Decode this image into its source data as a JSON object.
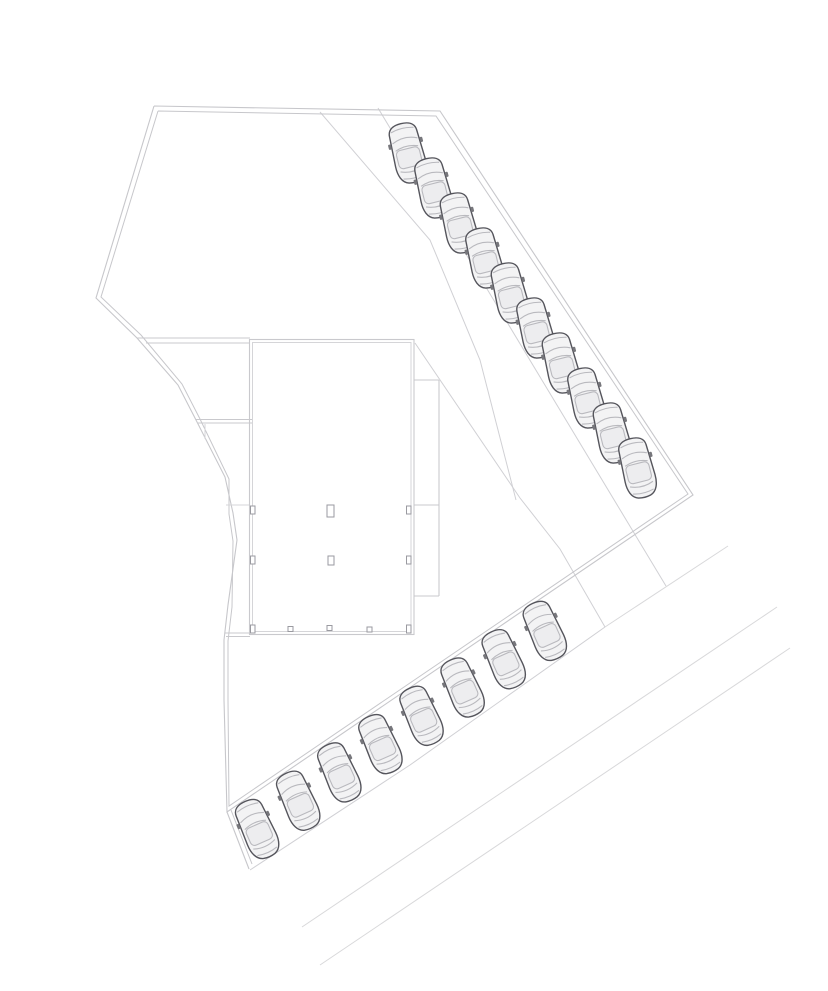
{
  "page": {
    "title": "Architectural site plan with building footprint and angled parking",
    "background": "#ffffff"
  },
  "drawing": {
    "width": 828,
    "height": 991,
    "colors": {
      "boundary": "#c7c7cb",
      "wall": "#c9c9cd",
      "wall_light": "#d5d5d8",
      "aisle_line": "#d0d0d4",
      "road_line": "#d8d8da",
      "car_outline": "#55555c",
      "car_body": "#f3f3f4",
      "car_glass": "#b9b9be",
      "car_roof": "#ededef",
      "car_mirror": "#77777c",
      "column": "#9a9aa0",
      "column_fill": "#ffffff"
    },
    "site_boundary": {
      "outer": [
        [
          154,
          106
        ],
        [
          440,
          111
        ],
        [
          693,
          495
        ],
        [
          227,
          812
        ],
        [
          224,
          700
        ],
        [
          224,
          640
        ],
        [
          228,
          605
        ],
        [
          237,
          540
        ],
        [
          233,
          513
        ],
        [
          225,
          477
        ],
        [
          196,
          420
        ],
        [
          178,
          385
        ],
        [
          137,
          338
        ],
        [
          96,
          298
        ],
        [
          154,
          106
        ]
      ],
      "inner": [
        [
          158,
          111
        ],
        [
          436,
          116
        ],
        [
          688,
          494
        ],
        [
          229,
          806
        ],
        [
          228,
          700
        ],
        [
          228,
          641
        ],
        [
          232,
          607
        ],
        [
          233,
          541
        ],
        [
          229,
          514
        ],
        [
          229,
          479
        ],
        [
          200,
          419
        ],
        [
          182,
          384
        ],
        [
          141,
          335
        ],
        [
          101,
          297
        ],
        [
          158,
          111
        ]
      ],
      "tail_outer": [
        [
          227,
          812
        ],
        [
          249,
          869
        ]
      ],
      "tail_inner": [
        [
          231,
          810
        ],
        [
          252,
          864
        ]
      ]
    },
    "building": {
      "main_hall_outer": [
        249.5,
        339.5,
        164.5,
        295
      ],
      "main_hall_inner": [
        252.5,
        342.5,
        158.5,
        289
      ],
      "annex_lines": [
        [
          [
            414,
            380
          ],
          [
            439,
            380
          ]
        ],
        [
          [
            439,
            380
          ],
          [
            439,
            596
          ]
        ],
        [
          [
            414,
            596
          ],
          [
            439,
            596
          ]
        ],
        [
          [
            414,
            505
          ],
          [
            439,
            505
          ]
        ]
      ],
      "wing_walls": [
        [
          [
            137,
            338
          ],
          [
            250,
            338
          ]
        ],
        [
          [
            146,
            343
          ],
          [
            250,
            343
          ]
        ],
        [
          [
            196,
            419.5
          ],
          [
            252,
            419.5
          ]
        ],
        [
          [
            198,
            423
          ],
          [
            252,
            423
          ]
        ],
        [
          [
            225,
            633
          ],
          [
            250,
            633
          ]
        ],
        [
          [
            226,
            636.5
          ],
          [
            250,
            636.5
          ]
        ]
      ],
      "fence_line": [
        [
          226,
          505
        ],
        [
          249,
          505
        ]
      ],
      "door_tick": [
        [
          205,
          424
        ],
        [
          205,
          439
        ]
      ],
      "interior_columns": [
        [
          327,
          505,
          7,
          12
        ],
        [
          328,
          556,
          6,
          9
        ]
      ],
      "wall_columns": [
        [
          250.5,
          506,
          4.5,
          8
        ],
        [
          250.5,
          556,
          4.5,
          8
        ],
        [
          250.5,
          625,
          4.5,
          8
        ],
        [
          406.5,
          506,
          4.5,
          8
        ],
        [
          406.5,
          556,
          4.5,
          8
        ],
        [
          406.5,
          625,
          4.5,
          8
        ]
      ],
      "bottom_ticks": [
        [
          288,
          626.5,
          5,
          5
        ],
        [
          327,
          625.5,
          5,
          5
        ],
        [
          367,
          627,
          5,
          5
        ]
      ]
    },
    "parking_lines": {
      "bay_line_ne": [
        [
          378,
          108
        ],
        [
          666,
          586
        ]
      ],
      "aisle_curve": [
        [
          320,
          112
        ],
        [
          430,
          240
        ],
        [
          480,
          360
        ],
        [
          516,
          500
        ]
      ],
      "building_diagonal": [
        [
          415,
          343
        ],
        [
          520,
          498
        ],
        [
          560,
          549
        ],
        [
          605,
          627
        ]
      ],
      "south_lower": [
        [
          250,
          870
        ],
        [
          410,
          765
        ],
        [
          605,
          627
        ]
      ]
    },
    "roads": [
      [
        [
          605,
          627
        ],
        [
          728,
          546
        ]
      ],
      [
        [
          302,
          927
        ],
        [
          777,
          607
        ]
      ],
      [
        [
          320,
          965
        ],
        [
          790,
          648
        ]
      ]
    ],
    "parking_rows": [
      {
        "name": "northeast-row",
        "count": 10,
        "start": [
          408,
          153
        ],
        "step": [
          25.5,
          35.0
        ],
        "rotation": -14
      },
      {
        "name": "south-row",
        "count": 8,
        "start": [
          545,
          631
        ],
        "step": [
          -41.1,
          28.3
        ],
        "rotation": -24
      }
    ]
  }
}
